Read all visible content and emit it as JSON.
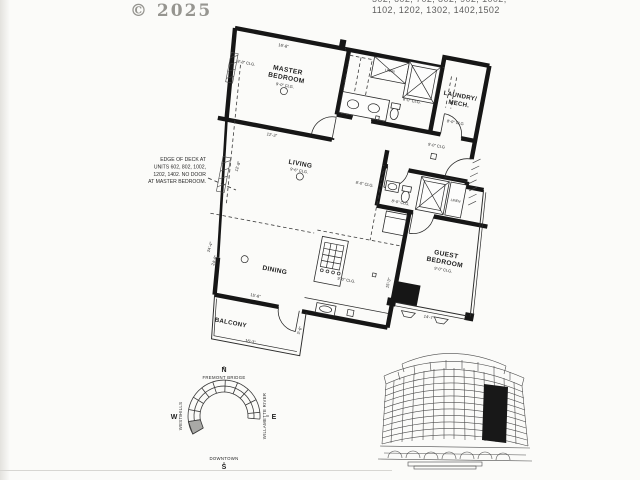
{
  "watermark": "© 2025",
  "header_units": {
    "line1": "502, 602, 702, 802, 902, 1002,",
    "line2": "1102, 1202, 1302, 1402,1502"
  },
  "plan": {
    "rooms": {
      "master": {
        "name1": "MASTER",
        "name2": "BEDROOM",
        "clg": "9'-0\" CLG."
      },
      "living": {
        "name1": "LIVING",
        "clg": "9'-6\" CLG."
      },
      "dining": {
        "name1": "DINING"
      },
      "balcony": {
        "name1": "BALCONY"
      },
      "guest": {
        "name1": "GUEST",
        "name2": "BEDROOM",
        "clg": "9'-0\" CLG."
      },
      "laundry": {
        "name1": "LAUNDRY/",
        "name2": "MECH.",
        "clg": "8'-0\" CLG"
      },
      "kitchen": {
        "clg": "9'-0\" CLG."
      },
      "entry": {
        "clg": "9'-0\" CLG"
      },
      "hall": {
        "clg": "8'-0\" CLG."
      },
      "master_bath": {
        "clg": "8'-0\" CLG."
      },
      "guest_bath": {
        "clg": "8'-0\" CLG."
      },
      "west_wall": {
        "clg": "8'-8\" CLG."
      }
    },
    "closets": {
      "linen_master": "LINEN",
      "linen_guest": "LINEN"
    },
    "dims": {
      "master_top": "16'-8\"",
      "master_bottom": "12'-3\"",
      "living_side": "12'-8\"",
      "dining_bottom": "15'-6\"",
      "balcony_bottom": "16'-3\"",
      "balcony_side": "5'-6\"",
      "guest_bottom": "14'-7\"",
      "kitchen_side": "15'-3\"",
      "west_upper": "24'-4\"",
      "west_lower": "24'-8\""
    },
    "note_lines": [
      "EDGE OF DECK AT",
      "UNITS 602, 802, 1002,",
      "1202, 1402.  NO DOOR",
      "AT MASTER BEDROOM."
    ]
  },
  "locator": {
    "n": "N",
    "s": "S",
    "e": "E",
    "w": "W",
    "north_label": "FREMONT BRIDGE",
    "south_label": "DOWNTOWN",
    "east_label": "WILLAMETTE RIVER",
    "west_label": "WEST HILLS"
  },
  "colors": {
    "ink": "#1f1f1f",
    "paper": "#fbfbf9",
    "watermark": "#969590"
  }
}
